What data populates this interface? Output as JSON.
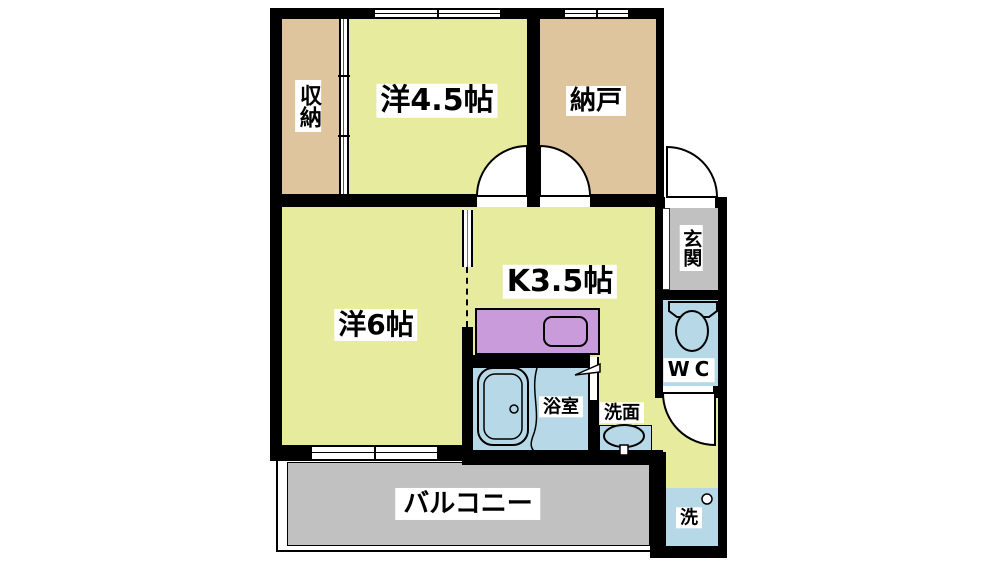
{
  "plan": {
    "title": "2K apartment floor plan",
    "rooms": {
      "closet": {
        "label": "収納"
      },
      "western_4_5": {
        "label": "洋4.5帖"
      },
      "storeroom": {
        "label": "納戸"
      },
      "western_6": {
        "label": "洋6帖"
      },
      "kitchen": {
        "label": "K3.5帖"
      },
      "entrance": {
        "label": "玄関"
      },
      "wc": {
        "label": "WC"
      },
      "bathroom": {
        "label": "浴室"
      },
      "washroom": {
        "label": "洗面"
      },
      "laundry": {
        "label": "洗"
      },
      "balcony": {
        "label": "バルコニー"
      }
    },
    "colors": {
      "wall": "#000000",
      "room_yellow": "#e7eb9d",
      "closet_tan": "#dfc59d",
      "wet_area_cyan": "#b7d9e7",
      "counter_purple": "#c99bdb",
      "concrete_gray": "#c1c1c1",
      "label_bg": "#ffffff",
      "label_text": "#000000",
      "background": "#ffffff"
    },
    "icons": {
      "bathtub": "bathtub-icon",
      "toilet": "toilet-icon",
      "washbasin": "washbasin-icon",
      "kitchen_sink": "kitchen-sink-icon",
      "faucet": "faucet-dot-icon",
      "door_swing": "door-swing-icon",
      "window": "window-symbol",
      "sliding_door": "sliding-door-symbol"
    }
  }
}
